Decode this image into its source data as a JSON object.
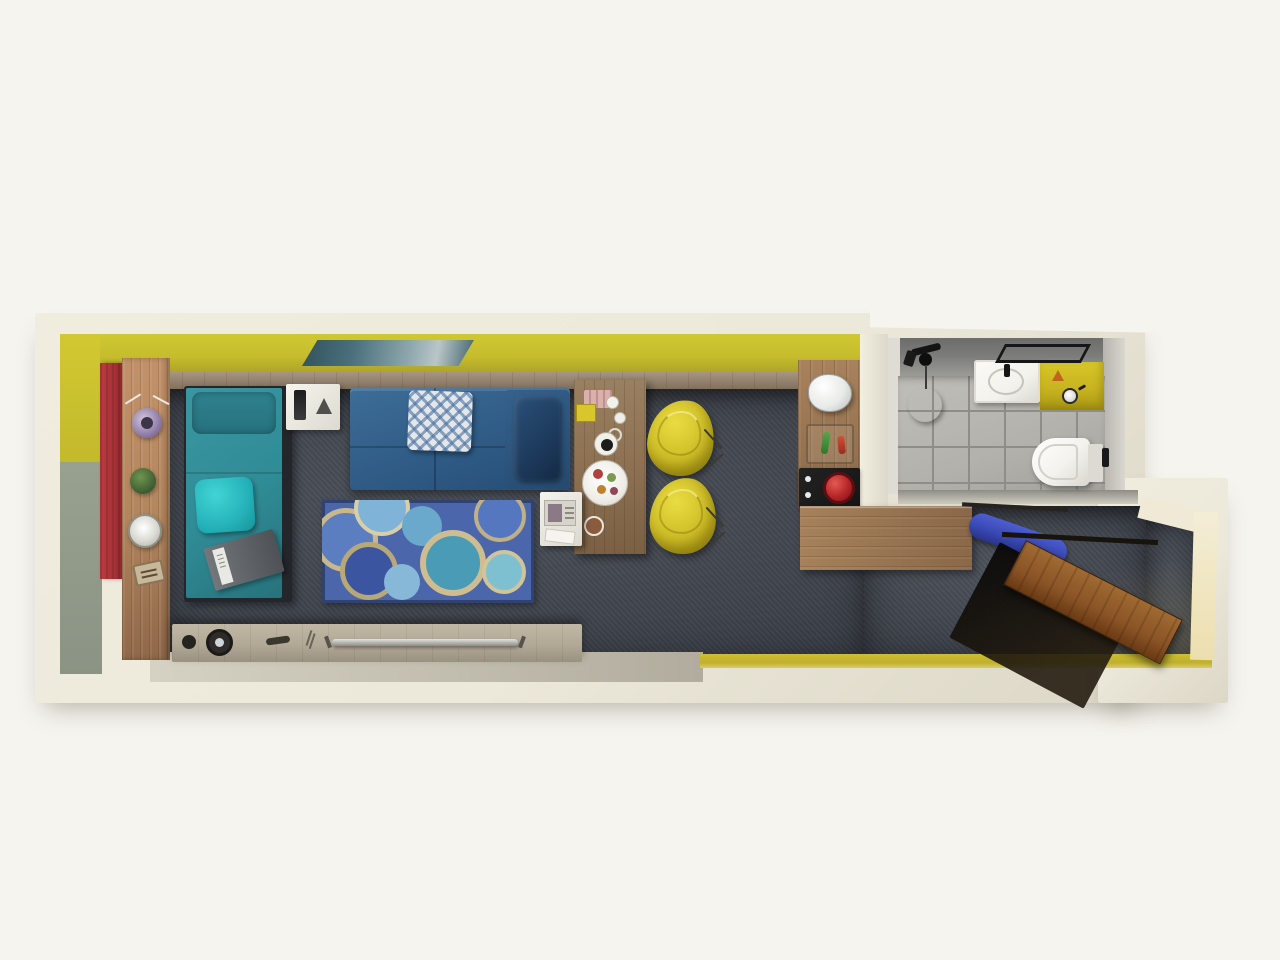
{
  "scene": {
    "type": "3d-floorplan-top-view",
    "description": "3D top-down floor plan rendering of a long studio apartment",
    "areas": [
      {
        "name": "living-sleeping-area",
        "label": "Living / sleeping area"
      },
      {
        "name": "kitchenette",
        "label": "Kitchenette"
      },
      {
        "name": "bathroom",
        "label": "Bathroom"
      },
      {
        "name": "entry-hall",
        "label": "Entry hall"
      }
    ]
  },
  "palette": {
    "page_bg": "#f6f4ef",
    "wall_cream": "#ece8da",
    "wall_cream_dark": "#dcd7c6",
    "wall_yellow": "#c6bd2e",
    "wall_yellow_bright": "#d2c931",
    "wall_olive": "#98a08f",
    "curtain_red": "#aa3338",
    "wood_shelf": "#b3875e",
    "wood_panel": "#91816c",
    "wood_desk": "#8c6f50",
    "wood_counter": "#9c7852",
    "carpet": "#3f444e",
    "bed_teal": "#2f8b95",
    "pillow_teal": "#26727e",
    "cushion_turquoise": "#25b3b9",
    "sofa_blue": "#2f5b85",
    "sofa_navy": "#1d3a5c",
    "rug_blue": "#4b66aa",
    "chair_yellow": "#cdbd27",
    "tile_floor": "#b3b1ab",
    "tile_grout": "#8f8d87",
    "bath_wall": "#7c7c7a",
    "vanity_yellow": "#c8b420",
    "kettle_white": "#e9ebe8",
    "cooktop_black": "#151515",
    "pot_red": "#b52528",
    "ironing_blue": "#3a49b4",
    "door_wood": "#8a5426",
    "strip_yellow": "#c0b02a",
    "sideboard_gray": "#b2a896",
    "toilet_white": "#f3f2ed",
    "art_teal": "#49707c"
  },
  "furniture": [
    {
      "name": "seascape-wall-art",
      "area": "living-sleeping-area"
    },
    {
      "name": "red-curtain-panel",
      "area": "living-sleeping-area"
    },
    {
      "name": "flower-vase",
      "area": "living-sleeping-area"
    },
    {
      "name": "potted-plant",
      "area": "living-sleeping-area"
    },
    {
      "name": "white-flower-bowl",
      "area": "living-sleeping-area"
    },
    {
      "name": "decor-tray",
      "area": "living-sleeping-area"
    },
    {
      "name": "teal-daybed",
      "area": "living-sleeping-area"
    },
    {
      "name": "teal-pillow",
      "area": "living-sleeping-area"
    },
    {
      "name": "turquoise-cushion",
      "area": "living-sleeping-area"
    },
    {
      "name": "open-book",
      "area": "living-sleeping-area"
    },
    {
      "name": "white-nightstand",
      "area": "living-sleeping-area"
    },
    {
      "name": "desk-lamp",
      "area": "living-sleeping-area"
    },
    {
      "name": "blue-sofa-bed",
      "area": "living-sleeping-area"
    },
    {
      "name": "diamond-pattern-pillow",
      "area": "living-sleeping-area"
    },
    {
      "name": "navy-cushion",
      "area": "living-sleeping-area"
    },
    {
      "name": "circle-pattern-rug",
      "area": "living-sleeping-area"
    },
    {
      "name": "wooden-desk",
      "area": "living-sleeping-area"
    },
    {
      "name": "breakfast-plate",
      "area": "living-sleeping-area"
    },
    {
      "name": "coffee-cups",
      "area": "living-sleeping-area"
    },
    {
      "name": "white-side-table",
      "area": "living-sleeping-area"
    },
    {
      "name": "magazine",
      "area": "living-sleeping-area"
    },
    {
      "name": "yellow-tub-chair-1",
      "area": "living-sleeping-area"
    },
    {
      "name": "yellow-tub-chair-2",
      "area": "living-sleeping-area"
    },
    {
      "name": "media-sideboard",
      "area": "living-sleeping-area"
    },
    {
      "name": "speaker",
      "area": "living-sleeping-area"
    },
    {
      "name": "metal-rail",
      "area": "living-sleeping-area"
    },
    {
      "name": "kitchen-shelf-strip",
      "area": "kitchenette"
    },
    {
      "name": "electric-kettle",
      "area": "kitchenette"
    },
    {
      "name": "condiment-tray",
      "area": "kitchenette"
    },
    {
      "name": "black-cooktop",
      "area": "kitchenette"
    },
    {
      "name": "red-saucepan",
      "area": "kitchenette"
    },
    {
      "name": "l-shaped-counter",
      "area": "kitchenette"
    },
    {
      "name": "shower-set",
      "area": "bathroom"
    },
    {
      "name": "shower-stool",
      "area": "bathroom"
    },
    {
      "name": "wash-basin",
      "area": "bathroom"
    },
    {
      "name": "yellow-vanity-counter",
      "area": "bathroom"
    },
    {
      "name": "toiletries-jar",
      "area": "bathroom"
    },
    {
      "name": "towel-rail",
      "area": "bathroom"
    },
    {
      "name": "wall-hung-toilet",
      "area": "bathroom"
    },
    {
      "name": "door-handle",
      "area": "bathroom"
    },
    {
      "name": "ironing-board",
      "area": "entry-hall"
    },
    {
      "name": "entrance-door",
      "area": "entry-hall"
    }
  ]
}
